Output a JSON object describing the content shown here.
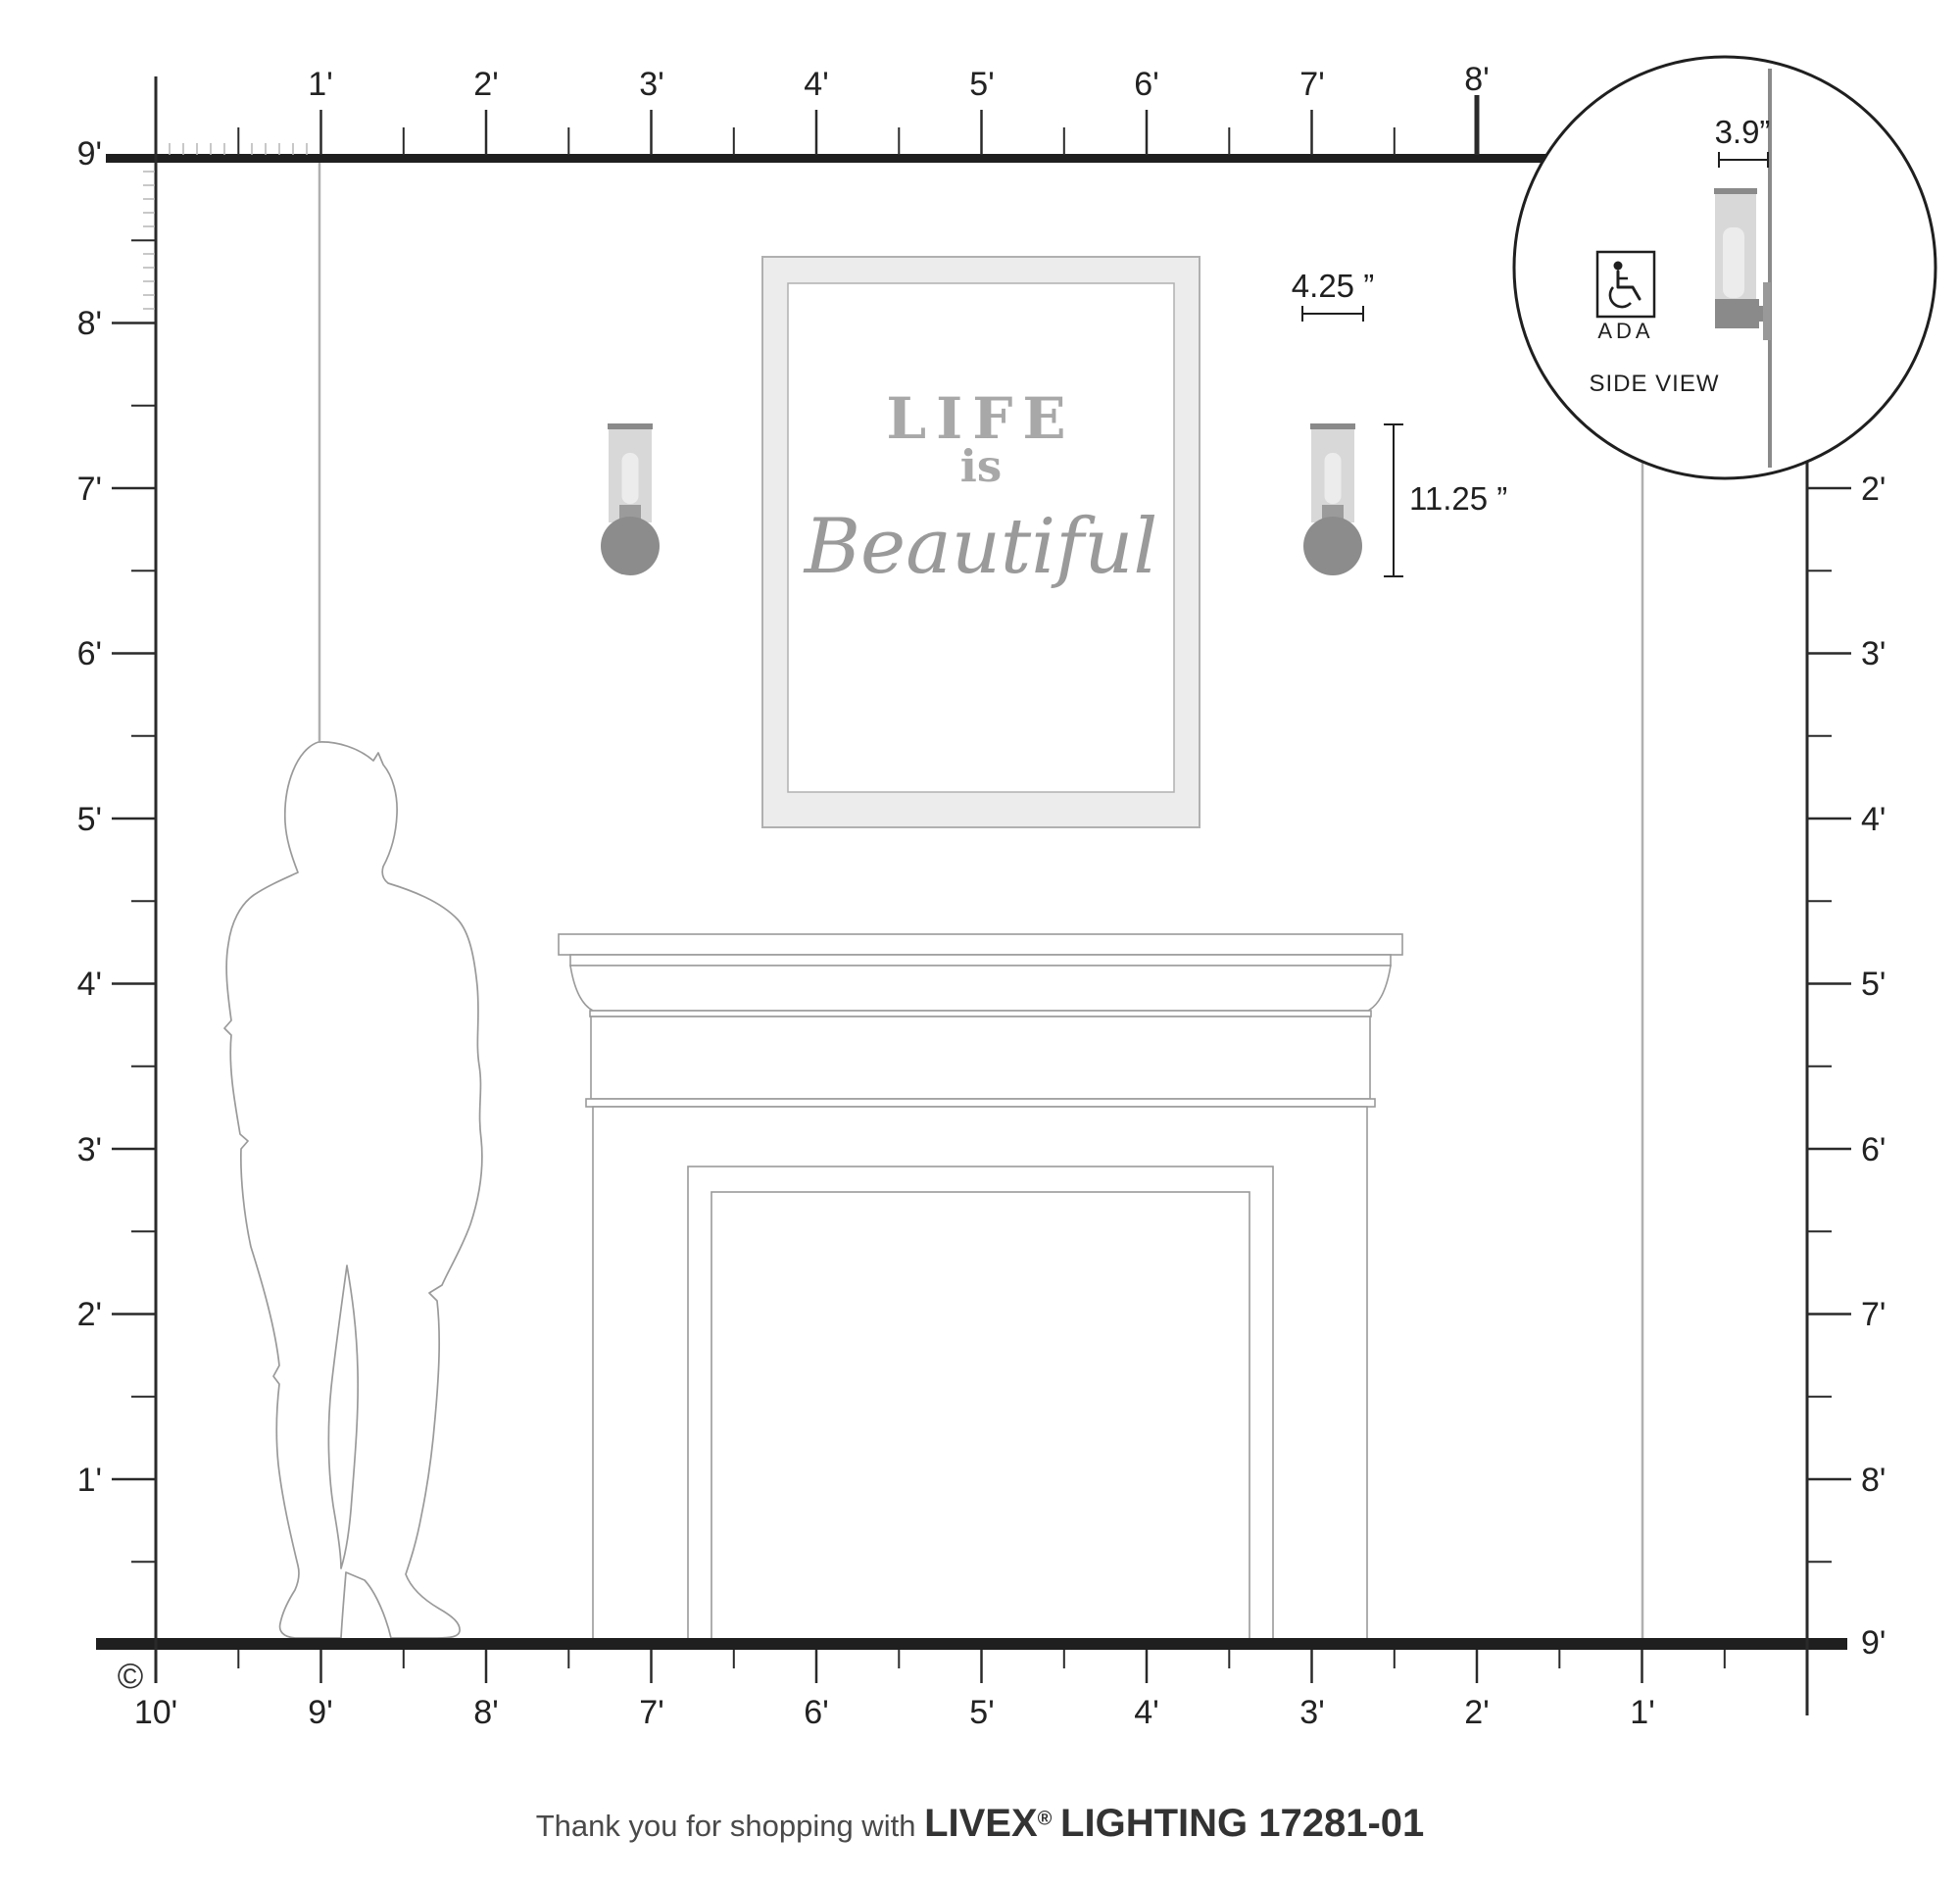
{
  "rulers": {
    "top": {
      "labels": [
        "1'",
        "2'",
        "3'",
        "4'",
        "5'",
        "6'",
        "7'",
        "8'"
      ]
    },
    "left": {
      "labels": [
        "9'",
        "8'",
        "7'",
        "6'",
        "5'",
        "4'",
        "3'",
        "2'",
        "1'"
      ]
    },
    "right": {
      "labels": [
        "2'",
        "3'",
        "4'",
        "5'",
        "6'",
        "7'",
        "8'",
        "9'"
      ]
    },
    "bottom": {
      "labels": [
        "10'",
        "9'",
        "8'",
        "7'",
        "6'",
        "5'",
        "4'",
        "3'",
        "2'",
        "1'"
      ]
    }
  },
  "artwork": {
    "line1": "LIFE",
    "line2": "is",
    "line3": "Beautiful"
  },
  "fixture": {
    "width_label": "4.25 ”",
    "height_label": "11.25 ”",
    "depth_label": "3.9”"
  },
  "inset": {
    "ada_label": "ADA",
    "title": "SIDE VIEW"
  },
  "footer": {
    "message": "Thank you for shopping with",
    "brand": "LIVEX",
    "registered": "®",
    "product": "LIGHTING 17281-01"
  },
  "copyright_symbol": "©",
  "colors": {
    "line": "#1f1f1f",
    "outline": "#9a9a9a",
    "fixture_gray": "#8c8c8c",
    "glass_gray": "#d8d8d8",
    "ref_line": "#b0b0b0"
  }
}
